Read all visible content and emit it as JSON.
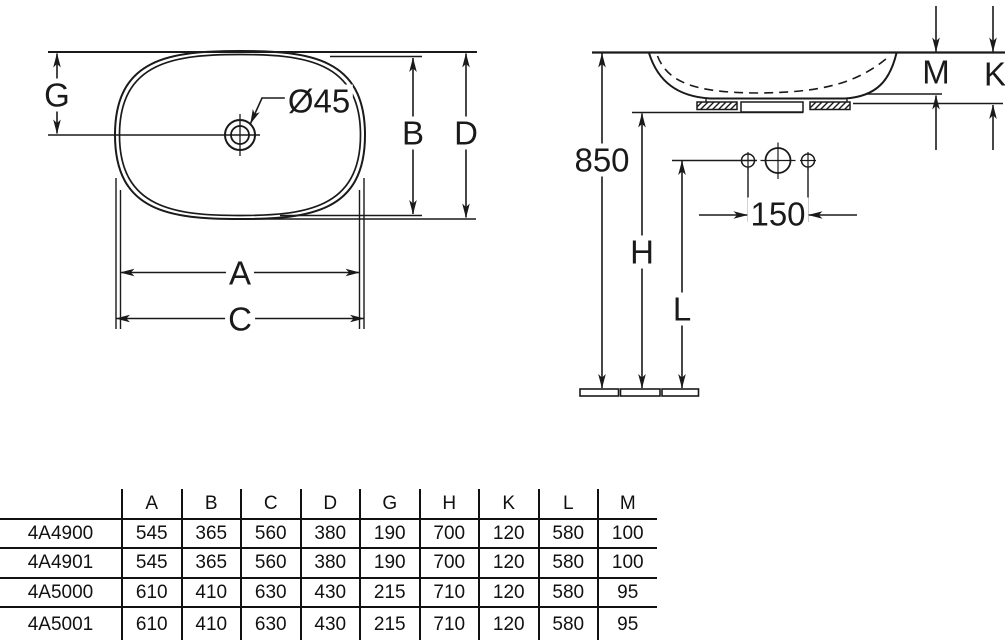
{
  "drawing": {
    "top_view": {
      "hole_diameter_label": "Ø45",
      "dim_g": "G",
      "dim_b": "B",
      "dim_d": "D",
      "dim_a": "A",
      "dim_c": "C"
    },
    "side_view": {
      "install_height": "850",
      "dim_m": "M",
      "dim_k": "K",
      "dim_h": "H",
      "dim_l": "L",
      "tap_hole_spacing": "150"
    }
  },
  "table": {
    "headers": [
      "",
      "A",
      "B",
      "C",
      "D",
      "G",
      "H",
      "K",
      "L",
      "M"
    ],
    "rows": [
      {
        "model": "4A4900",
        "values": [
          "545",
          "365",
          "560",
          "380",
          "190",
          "700",
          "120",
          "580",
          "100"
        ]
      },
      {
        "model": "4A4901",
        "values": [
          "545",
          "365",
          "560",
          "380",
          "190",
          "700",
          "120",
          "580",
          "100"
        ]
      },
      {
        "model": "4A5000",
        "values": [
          "610",
          "410",
          "630",
          "430",
          "215",
          "710",
          "120",
          "580",
          "95"
        ]
      },
      {
        "model": "4A5001",
        "values": [
          "610",
          "410",
          "630",
          "430",
          "215",
          "710",
          "120",
          "580",
          "95"
        ]
      }
    ]
  }
}
